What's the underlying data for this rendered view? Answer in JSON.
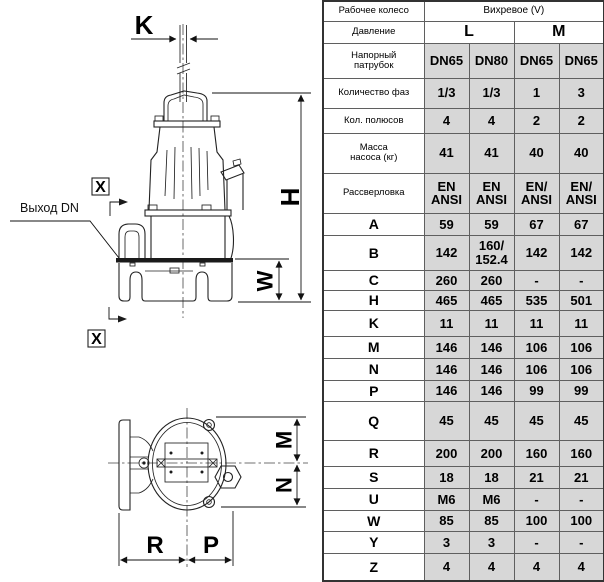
{
  "drawing": {
    "labels": {
      "k": "K",
      "h": "H",
      "w": "W",
      "m": "M",
      "n": "N",
      "r": "R",
      "p": "P"
    },
    "outlet_label": "Выход DN",
    "section_marker": "X"
  },
  "table": {
    "header": {
      "impeller_label": "Рабочее колесо",
      "impeller_value": "Вихревое (V)",
      "pressure_label": "Давление",
      "pressure_options": [
        "L",
        "M"
      ],
      "outlet_label": "Напорный\nпатрубок",
      "outlet_values": [
        "DN65",
        "DN80",
        "DN65",
        "DN65"
      ]
    },
    "rows": [
      {
        "label": "Количество фаз",
        "values": [
          "1/3",
          "1/3",
          "1",
          "3"
        ]
      },
      {
        "label": "Кол. полюсов",
        "values": [
          "4",
          "4",
          "2",
          "2"
        ]
      },
      {
        "label": "Масса\nнасоса (кг)",
        "values": [
          "41",
          "41",
          "40",
          "40"
        ]
      },
      {
        "label": "Рассверловка",
        "values": [
          "EN\nANSI",
          "EN\nANSI",
          "EN/\nANSI",
          "EN/\nANSI"
        ]
      },
      {
        "label": "A",
        "values": [
          "59",
          "59",
          "67",
          "67"
        ]
      },
      {
        "label": "B",
        "values": [
          "142",
          "160/\n152.4",
          "142",
          "142"
        ]
      },
      {
        "label": "C",
        "values": [
          "260",
          "260",
          "-",
          "-"
        ]
      },
      {
        "label": "H",
        "values": [
          "465",
          "465",
          "535",
          "501"
        ]
      },
      {
        "label": "K",
        "values": [
          "11",
          "11",
          "11",
          "11"
        ]
      },
      {
        "label": "M",
        "values": [
          "146",
          "146",
          "106",
          "106"
        ]
      },
      {
        "label": "N",
        "values": [
          "146",
          "146",
          "106",
          "106"
        ]
      },
      {
        "label": "P",
        "values": [
          "146",
          "146",
          "99",
          "99"
        ]
      },
      {
        "label": "Q",
        "values": [
          "45",
          "45",
          "45",
          "45"
        ]
      },
      {
        "label": "R",
        "values": [
          "200",
          "200",
          "160",
          "160"
        ]
      },
      {
        "label": "S",
        "values": [
          "18",
          "18",
          "21",
          "21"
        ]
      },
      {
        "label": "U",
        "values": [
          "M6",
          "M6",
          "-",
          "-"
        ]
      },
      {
        "label": "W",
        "values": [
          "85",
          "85",
          "100",
          "100"
        ]
      },
      {
        "label": "Y",
        "values": [
          "3",
          "3",
          "-",
          "-"
        ]
      },
      {
        "label": "Z",
        "values": [
          "4",
          "4",
          "4",
          "4"
        ]
      }
    ]
  }
}
